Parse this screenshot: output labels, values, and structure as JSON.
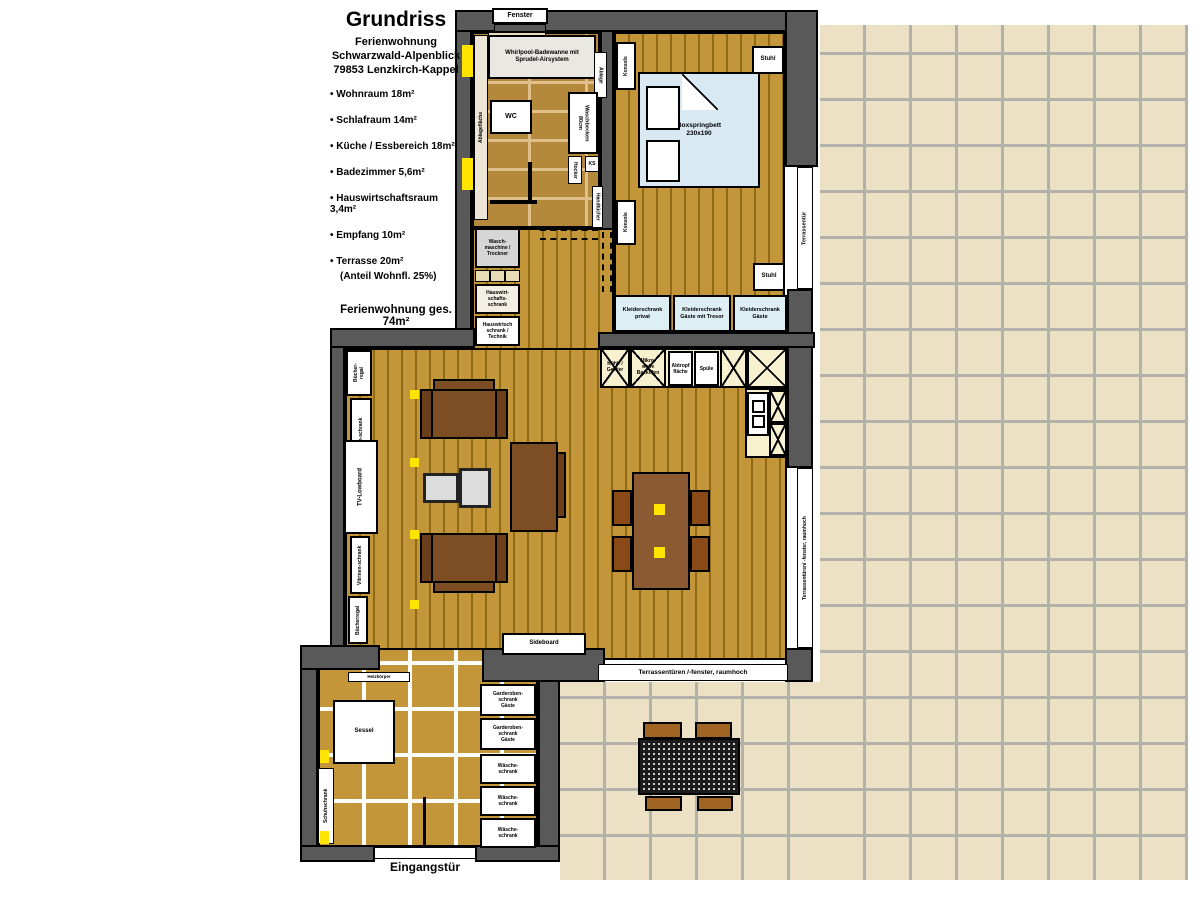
{
  "title_block": {
    "title": "Grundriss",
    "line1": "Ferienwohnung",
    "line2": "Schwarzwald-Alpenblick",
    "line3": "79853 Lenzkirch-Kappel",
    "rooms": [
      "Wohnraum 18m²",
      "Schlafraum 14m²",
      "Küche / Essbereich 18m²",
      "Badezimmer 5,6m²",
      "Hauswirtschaftsraum 3,4m²",
      "Empfang 10m²",
      "Terrasse 20m²"
    ],
    "terrace_note": "(Anteil Wohnfl. 25%)",
    "total": "Ferienwohnung ges. 74m²"
  },
  "bathroom": {
    "window": "Fenster",
    "tub": "Whirlpool-Badewanne mit\nSprudel-Airsystem",
    "shelf": "Ablagefläche",
    "wc": "WC",
    "sink": "Waschbecken\n80cm",
    "stool": "Hocker",
    "side_shelf": "Ablage",
    "ks": "KS",
    "towels": "Handtücher"
  },
  "bedroom": {
    "bed": "Boxspringbett\n230x190",
    "console_top": "Konsole",
    "console_bottom": "Konsole",
    "chair_top": "Stuhl",
    "chair_right": "Stuhl",
    "wardrobes": [
      "Kleiderschrank\nprivat",
      "Kleiderschrank\nGäste mit Tresor",
      "Kleiderschrank\nGäste"
    ]
  },
  "utility": {
    "washer": "Wasch-\nmaschine /\nTrockner",
    "cabinet1": "Hauswirt-\nschafts-\nschrank",
    "cabinet2": "Hauswirtsch\nschrank /\nTechnik"
  },
  "kitchen": {
    "fridge": "Kühl- /\nGefrier",
    "microwave": "Mikro-\nwelle\nBackofen",
    "drainer": "Abtropf\nfläche",
    "sink": "Spüle"
  },
  "living": {
    "bookshelf_top": "Bücher-\nregal",
    "vitrine_top": "Vitrinen-schrank",
    "tv": "TV-Lowboard",
    "vitrine_bottom": "Vitrinen-schrank",
    "bookshelf_bottom": "Bücherregal",
    "sideboard": "Sideboard"
  },
  "entrance": {
    "radiator": "Heizkörper",
    "armchair": "Sessel",
    "shoe_cabinet": "Schuhschrank",
    "cabinets": [
      "Garderoben-\nschrank\nGäste",
      "Garderoben-\nschrank\nGäste",
      "Wäsche-\nschrank",
      "Wäsche-\nschrank",
      "Wäsche-\nschrank"
    ],
    "door": "Eingangstür"
  },
  "doors": {
    "terrace_door": "Terrassentür",
    "terrace_doors_right": "Terrassentüren/ -fenster, raumhoch",
    "terrace_doors_bottom": "Terrassentüren /-fenster, raumhoch"
  },
  "colors": {
    "wall": "#595959",
    "wood": "#c3963a",
    "bed": "#d9e9f3",
    "wardrobe": "#ddeef4",
    "kitchen_cabinet": "#f7f1cf",
    "terrace_tile": "#ece1c4",
    "accent_yellow": "#ffe400"
  }
}
